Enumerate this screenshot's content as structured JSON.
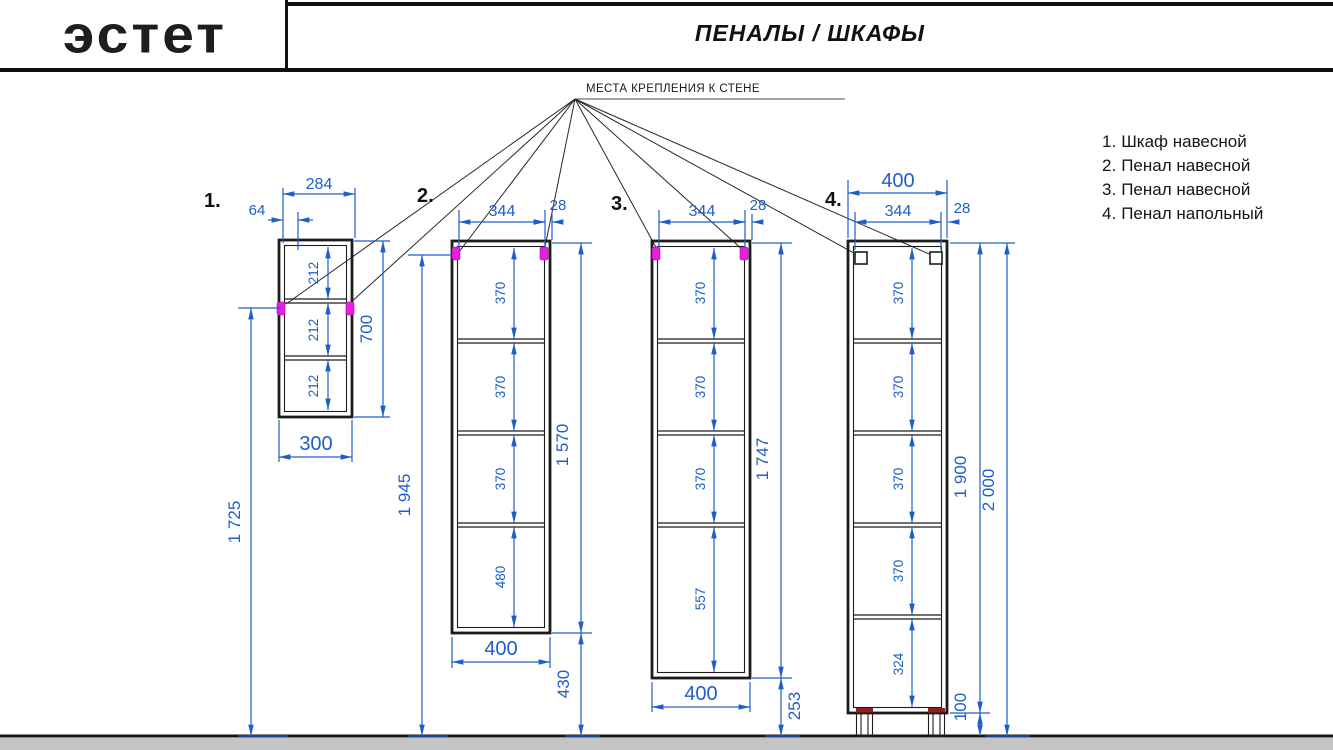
{
  "header": {
    "logo": "эстет",
    "title": "ПЕНАЛЫ / ШКАФЫ"
  },
  "drawing": {
    "mount_label": "МЕСТА КРЕПЛЕНИЯ К СТЕНЕ"
  },
  "colors": {
    "dimension_blue": "#1d5ec9",
    "mount_magenta": "#e81fe0",
    "line_black": "#1c1c1c",
    "floor_gray": "#c4c4c4"
  },
  "cabinets": [
    {
      "number": "1.",
      "name": "Шкаф навесной",
      "dims": {
        "top_width": "284",
        "mount_offset": "64",
        "compartments": [
          "212",
          "212",
          "212"
        ],
        "height": "700",
        "bottom_width": "300",
        "floor_height": "1 725"
      }
    },
    {
      "number": "2.",
      "name": "Пенал навесной",
      "dims": {
        "top_width": "344",
        "edge": "28",
        "compartments": [
          "370",
          "370",
          "370",
          "480"
        ],
        "height": "1 570",
        "bottom_width": "400",
        "below": "430",
        "total": "1 945"
      }
    },
    {
      "number": "3.",
      "name": "Пенал навесной",
      "dims": {
        "top_width": "344",
        "edge": "28",
        "compartments": [
          "370",
          "370",
          "370",
          "557"
        ],
        "height": "1 747",
        "bottom_width": "400",
        "below": "253"
      }
    },
    {
      "number": "4.",
      "name": "Пенал напольный",
      "dims": {
        "width": "400",
        "top_width": "344",
        "edge": "28",
        "compartments": [
          "370",
          "370",
          "370",
          "370",
          "324"
        ],
        "height": "1 900",
        "total": "2 000",
        "legs": "100"
      }
    }
  ]
}
